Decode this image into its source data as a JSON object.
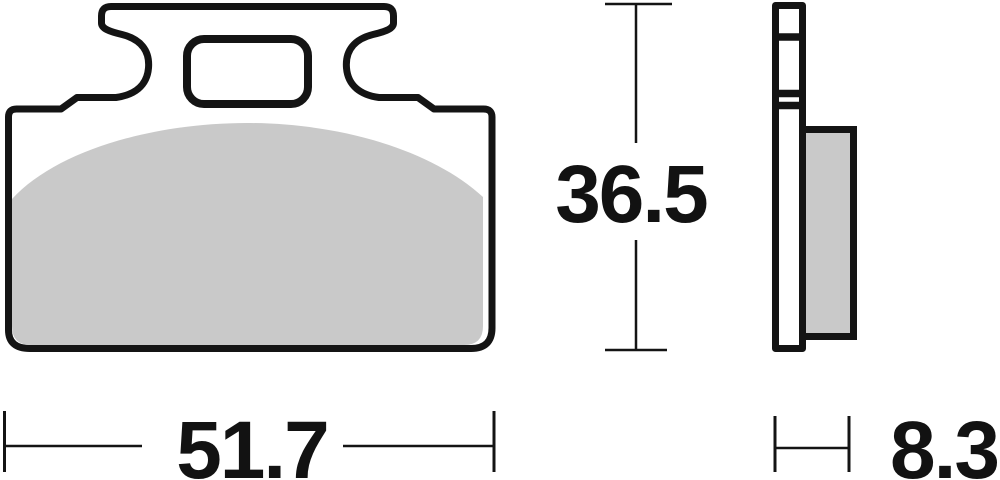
{
  "drawing": {
    "subject": "brake-pad-technical-drawing",
    "views": {
      "front": {
        "name": "front-view",
        "width_dimension": {
          "value": "51.7"
        },
        "height_dimension": {
          "value": "36.5"
        }
      },
      "side": {
        "name": "side-view",
        "thickness_dimension": {
          "value": "8.3"
        }
      }
    },
    "colors": {
      "outline": "#141414",
      "friction_pad_fill": "#c9c9c9",
      "background": "#ffffff",
      "dimension_text": "#121212"
    }
  }
}
